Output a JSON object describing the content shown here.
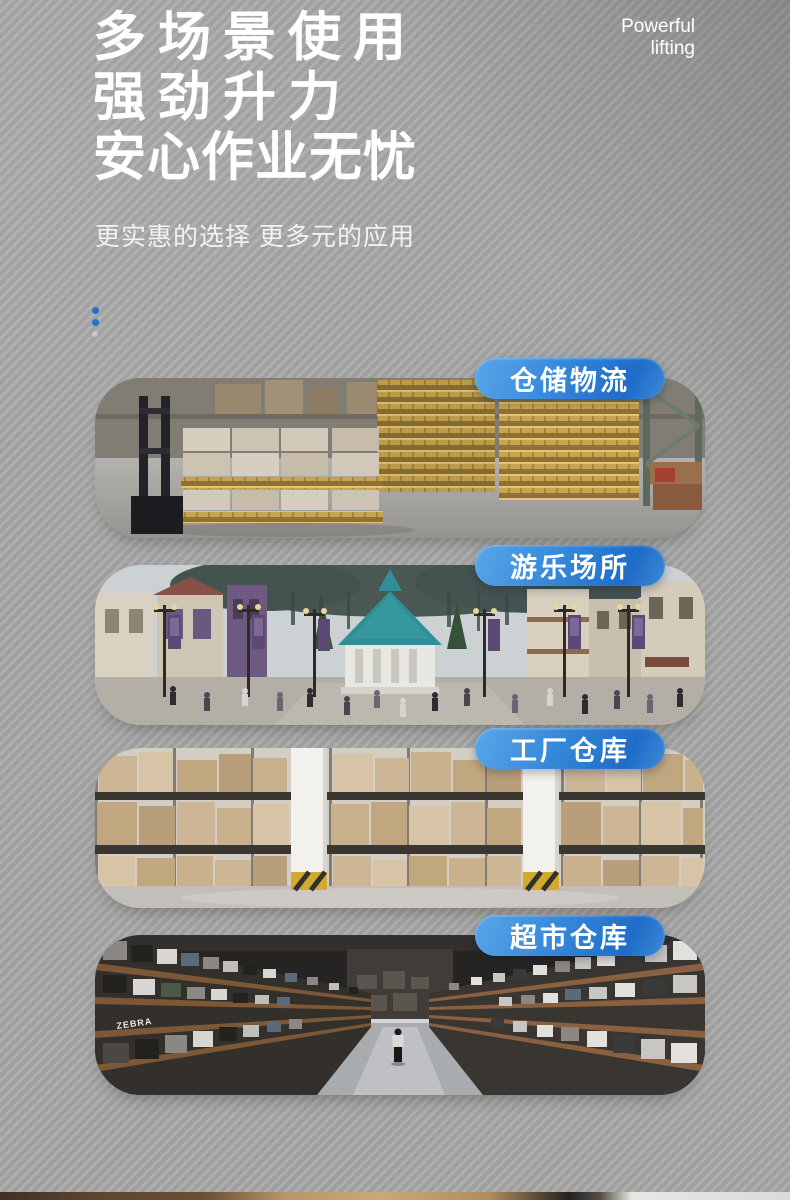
{
  "header": {
    "title_line1": "多场景使用",
    "title_line2": "强劲升力",
    "title_line3": "安心作业无忧",
    "tagline_line1": "Powerful",
    "tagline_line2": "lifting",
    "subtitle": "更实惠的选择 更多元的应用"
  },
  "cards": [
    {
      "label": "仓储物流",
      "scene": "warehouse-logistics"
    },
    {
      "label": "游乐场所",
      "scene": "amusement-park"
    },
    {
      "label": "工厂仓库",
      "scene": "factory-warehouse"
    },
    {
      "label": "超市仓库",
      "scene": "supermarket-warehouse"
    }
  ],
  "photo_texts": {
    "zebra_sign": "ZEBRA"
  },
  "colors": {
    "background_gray": "#a7a7a7",
    "text_white": "#ffffff",
    "accent_blue": "#1b74ce",
    "pill_blue_light": "#5aa6e8",
    "pill_blue_dark": "#1e6cc8"
  }
}
